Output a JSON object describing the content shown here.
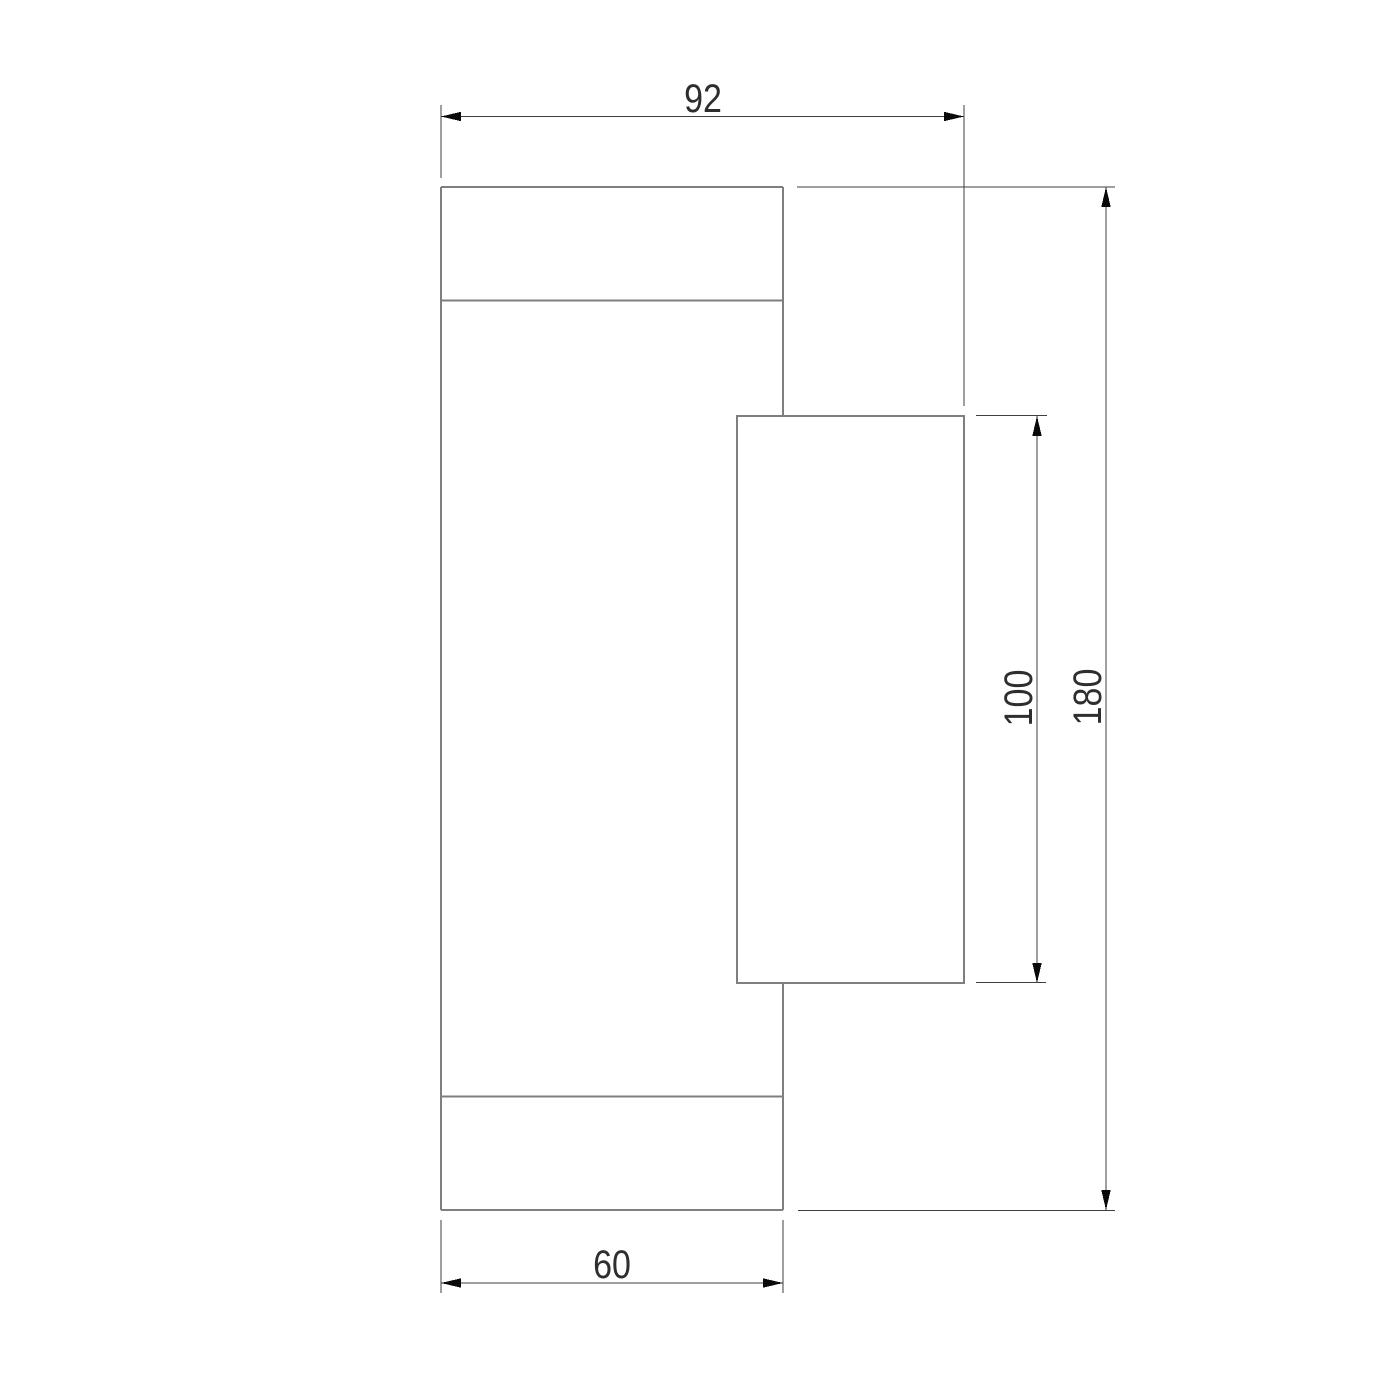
{
  "drawing": {
    "type": "technical dimension drawing (side elevation of wall light fixture)",
    "labels": {
      "top_width": "92",
      "bottom_width": "60",
      "inner_height": "100",
      "overall_height": "180"
    },
    "colors": {
      "background": "#ffffff",
      "object_line": "#7f7f7f",
      "dimension_line": "#3f3f3f",
      "arrowhead": "#0a0a0a",
      "text": "#2e2e2e"
    }
  }
}
